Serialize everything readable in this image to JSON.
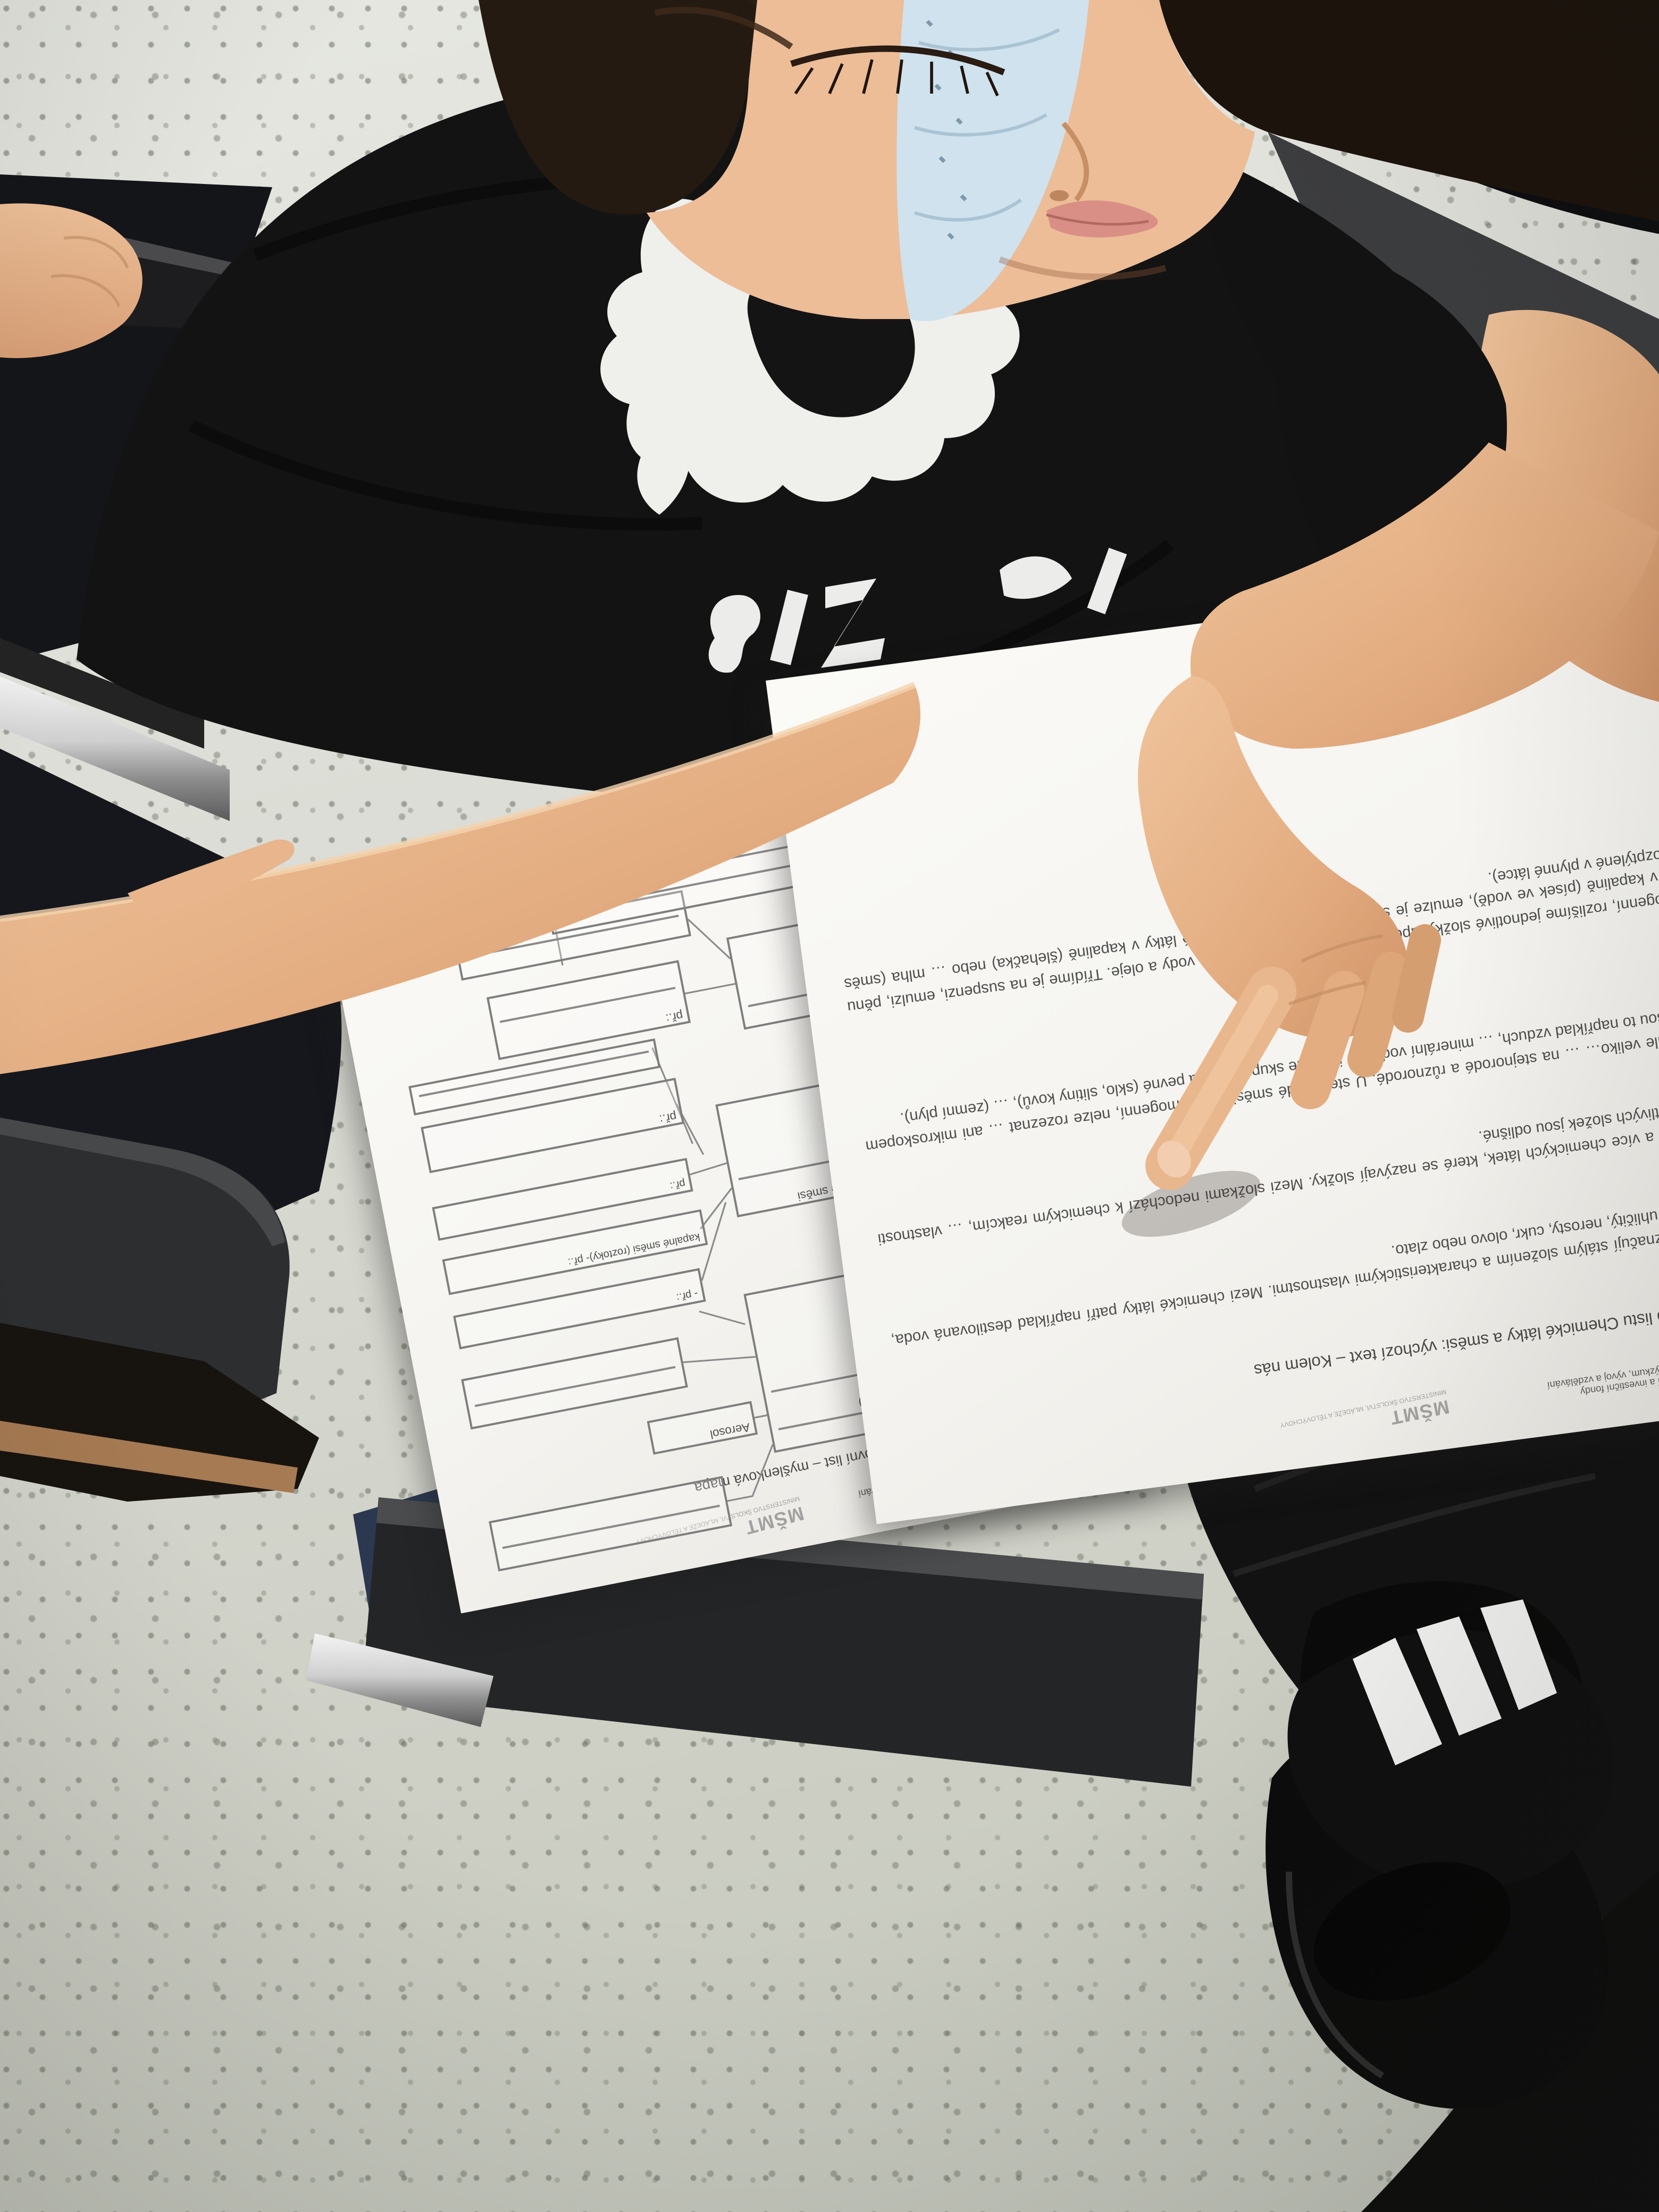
{
  "eu_logo": {
    "line1": "EVROPSKÁ UNIE",
    "line2": "Evropské strukturální a investiční fondy",
    "line3": "Operační program Výzkum, vývoj a vzdělávání",
    "ministry": "MŠMT",
    "ministry_caption": "MINISTERSTVO ŠKOLSTVÍ, MLÁDEŽE A TĚLOVÝCHOVY"
  },
  "right_paper": {
    "title": "Příloha 1 metodického listu Chemické látky a směsi: výchozí text – Kolem nás",
    "heading": "Kolem nás:",
    "paragraphs": [
      "Chemické látky se vyznačují stálým složením a charakteristickými vlastnostmi. Mezi chemické látky patří například destilovaná voda, líh, kyslík, dusík, oxid uhličitý, nerosty, cukr, olovo nebo zlato.",
      "Směs obsahuje dvě a více chemických látek, které se nazývají složky. Mezi složkami nedochází k chemickým reakcím, … vlastnosti směsí a jejich jednotlivých složek jsou odlišné.",
      "Směsi třídíme podle veliko… … na stejnorodé a různorodé. U stejnorodé směsi, též homogenní, nelze rozeznat … ani mikroskopem jednotlivé části. Jsou to například vzduch, … minerální vod… … je podle skupenství na pevné (sklo, slitiny kovů), … (zemní plyn).",
      "Směsi … heterogenní, rozlišíme jednotlivé složky lupou, okem nebo … žula, směs vody a oleje. Třídíme je na suspenzi, emulzi, pěnu … pevné látky v kapalině (písek ve vodě), emulze je směs dvou … je směs plynné látky v kapalině (šlehačka) nebo … mlha (směs kapalné látky rozptýlené v plynné látce)."
    ]
  },
  "left_paper": {
    "title": "…ho listu Chemické látky a směsi: pracovní list – myšlenková mapa",
    "nodes": {
      "central": "Kolem nás",
      "chemicke": "Chemické látky",
      "dash": "-",
      "priklad": "př.:",
      "priklad2": "př.:",
      "priklad3": "př.:",
      "priklad4": "- př.:",
      "stejnorode": "Stejnorodé směsi",
      "kapalne": "kapalné směsi (roztoky)- př.:",
      "aerosol": "Aerosol",
      "heterogenni": "(heterogenní)",
      "zula1": "př: žula, bronz,",
      "zula2": "emulze"
    }
  },
  "colors": {
    "eu_blue": "#3a5fc8",
    "eu_star": "#e8d44d",
    "paper": "#f5f4f1",
    "print_gray": "#4c4c4c",
    "skin": "#e7b28a",
    "shirt_black": "#141414",
    "mask_blue": "#cfe2ee",
    "floor_gray": "#d9dad3"
  }
}
